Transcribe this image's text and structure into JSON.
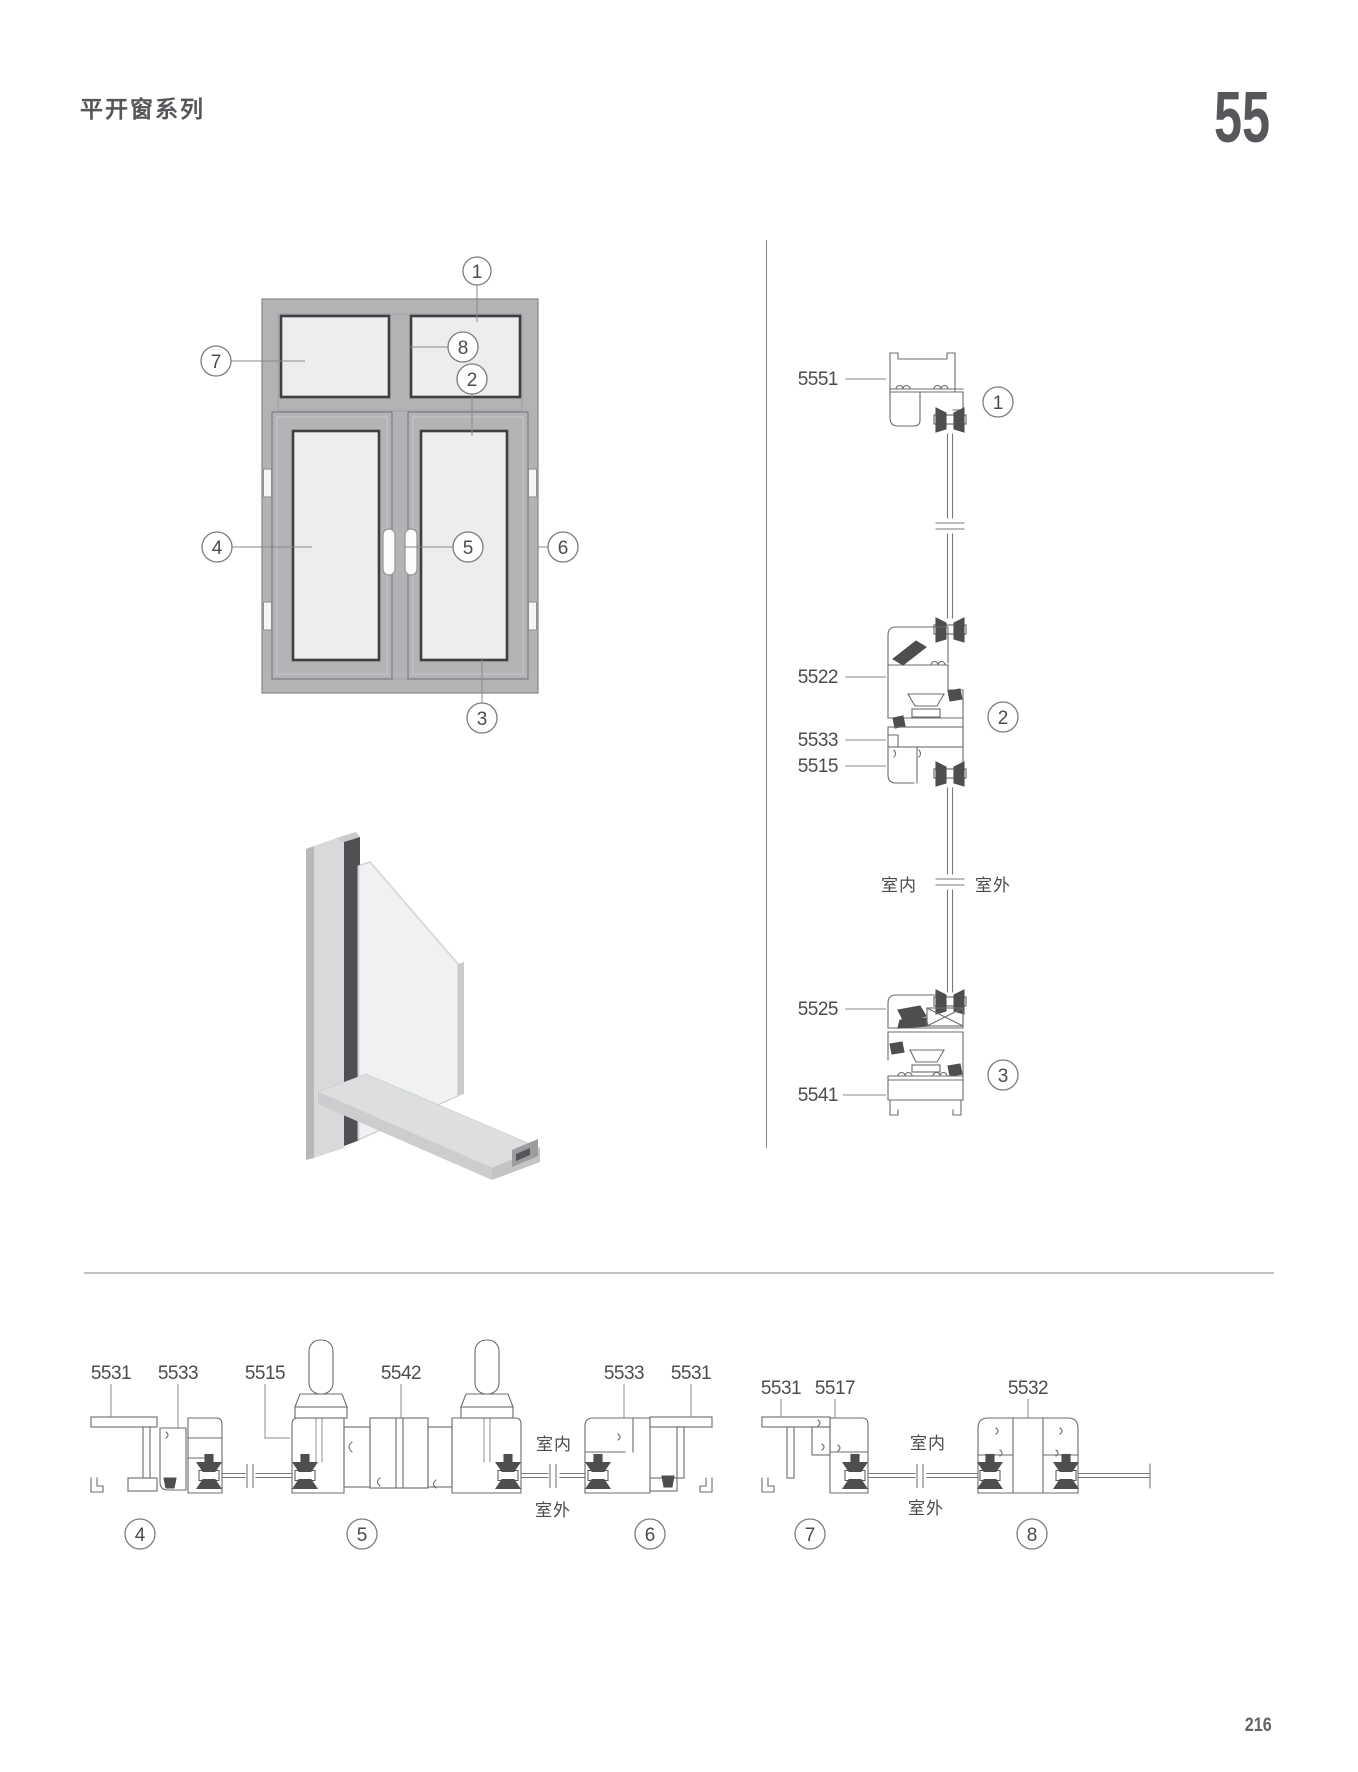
{
  "page": {
    "title": "平开窗系列",
    "big_number": "55",
    "footer_page": "216"
  },
  "colors": {
    "ink": "#55565a",
    "line": "#6b6c6e",
    "frame_fill": "#b1b3b5",
    "glass_fill": "#ecedee",
    "dark_detail": "#4d4e50"
  },
  "elevation": {
    "callouts": [
      "1",
      "2",
      "3",
      "4",
      "5",
      "6",
      "7",
      "8"
    ]
  },
  "vsection": {
    "labels": [
      "5551",
      "5522",
      "5533",
      "5515",
      "5525",
      "5541"
    ],
    "callouts": [
      "1",
      "2",
      "3"
    ],
    "indoor": "室内",
    "outdoor": "室外"
  },
  "bleft": {
    "labels": [
      "5531",
      "5533",
      "5515",
      "5542",
      "5533",
      "5531"
    ],
    "callouts": [
      "4",
      "5",
      "6"
    ],
    "indoor": "室内",
    "outdoor": "室外"
  },
  "bright": {
    "labels": [
      "5531",
      "5517",
      "5532"
    ],
    "callouts": [
      "7",
      "8"
    ],
    "indoor": "室内",
    "outdoor": "室外"
  }
}
